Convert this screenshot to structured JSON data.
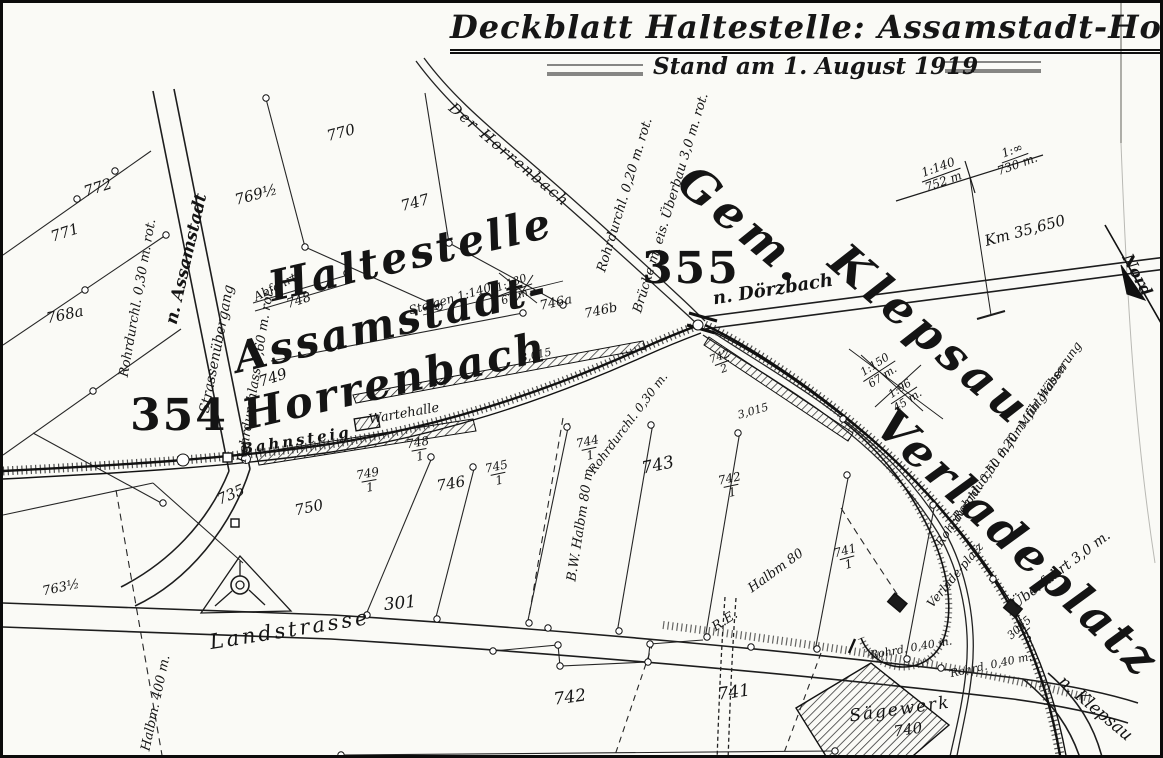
{
  "header": {
    "title": "Deckblatt Haltestelle: Assamstadt-Horrenb.",
    "date": "Stand am 1. August 1919"
  },
  "large_labels": {
    "station_line1": "Haltestelle",
    "station_line2": "Assamstadt-",
    "station_line3": "Horrenbach",
    "gemeinde": "Gem.",
    "klepsau": "Klepsau",
    "verladeplatz": "Verladeplatz",
    "num_354": "354",
    "num_355": "355"
  },
  "roads": {
    "to_assamstadt": "n. Assamstadt",
    "to_doerzbach": "n. Dörzbach",
    "to_klepsau": "n. Klepsau",
    "landstrasse": "Landstrasse",
    "strassenuebergang": "Strassenübergang",
    "stream": "Der Horrenbach"
  },
  "railway": {
    "bahnsteig": "Bahnsteig",
    "wartehalle": "Wartehalle",
    "abfahrt": "Abfahrt",
    "verlade_small": "Verlade-platz",
    "km_post": "Km 35,650",
    "nord": "Nord",
    "gauge_a": "3,015",
    "gauge_b": "3,015",
    "re": "R.E."
  },
  "structures": {
    "rohrdurchl_030": "Rohrdurchl. 0,30 m. rot.",
    "rohrdurchlass_060": "Rohrdurchlass 0,60 m. rot.",
    "rohrdurchl_020": "Rohrdurchl. 0,20 m. rot.",
    "bruecke": "Brücke m. eis. Überbau 3,0 m. rot.",
    "rohrdurchl_mid": "Rohrdurchl. 0,30 m.",
    "rohrdurchl_wasserung": "Rohrdurchl. 0,20 m. für Wässerung",
    "rohrdurchl_muehlgraben": "Rohrdurchl. 0,50 m für Mühlgraben",
    "ueberfahrt": "Überfahrt 3,0 m.",
    "rohrd_040_a": "Rohrd. 0,40 m.",
    "rohrd_040_b": "Rohrd. 0,40 m.",
    "bw_halbm": "B.W. Halbm 80 m.",
    "halbm_80": "Halbm 80",
    "halbm_400": "Halbm. 400 m.",
    "saegewerk": "Sägewerk"
  },
  "gradients": {
    "profile_left": {
      "top": "1:140",
      "bottom": "752 m"
    },
    "profile_right": {
      "top": "1:∞",
      "bottom": "730 m."
    },
    "steigen": "Steigen 1:140",
    "mid": {
      "top": "1:130",
      "bottom": "67 m."
    },
    "klepsau_a": {
      "top": "1:150",
      "bottom": "67 m."
    },
    "klepsau_b": {
      "top": "1:96",
      "bottom": "45 m."
    }
  },
  "parcels": {
    "p772": "772",
    "p771": "771",
    "p768a": "768a",
    "p769": "769½",
    "p770": "770",
    "p747": "747",
    "p748": "748",
    "p749": "749",
    "p750": "750",
    "p735": "735",
    "p746": "746",
    "p746a": "746a",
    "p746b": "746b",
    "p743": "743",
    "p742": "742",
    "p741": "741",
    "p740": "740",
    "p301": "301",
    "p763": "763½",
    "f748_1": {
      "n": "748",
      "d": "1"
    },
    "f749_1": {
      "n": "749",
      "d": "1"
    },
    "f745_1": {
      "n": "745",
      "d": "1"
    },
    "f744_1": {
      "n": "744",
      "d": "1"
    },
    "f742_1": {
      "n": "742",
      "d": "1"
    },
    "f741_1": {
      "n": "741",
      "d": "1"
    },
    "f742_2": {
      "n": "742",
      "d": "2"
    },
    "f3015_3": {
      "n": "3015",
      "d": "3"
    }
  },
  "colors": {
    "ink": "#161616",
    "paper": "#fafaf6"
  }
}
